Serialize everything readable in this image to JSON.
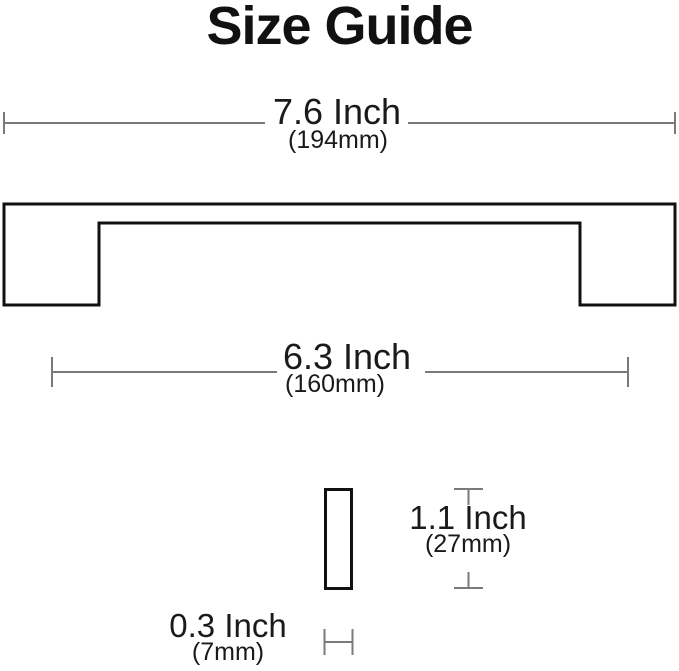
{
  "title": "Size Guide",
  "colors": {
    "text": "#1a1a1a",
    "dimension_line": "#7a7a7a",
    "drawing_outline": "#111111",
    "background": "#ffffff"
  },
  "dimensions": {
    "overall_width": {
      "label_inch": "7.6 Inch",
      "label_mm": "(194mm)"
    },
    "center_to_center": {
      "label_inch": "6.3 Inch",
      "label_mm": "(160mm)"
    },
    "side_height": {
      "label_inch": "1.1 Inch",
      "label_mm": "(27mm)"
    },
    "side_thickness": {
      "label_inch": "0.3 Inch",
      "label_mm": "(7mm)"
    }
  }
}
